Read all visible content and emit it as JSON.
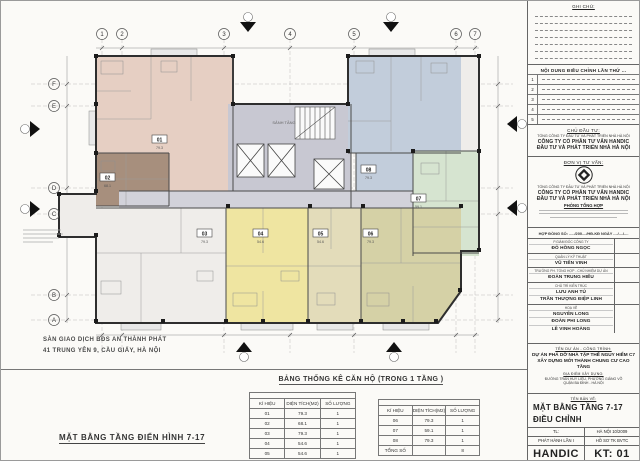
{
  "plan": {
    "grid_top": [
      "1",
      "2",
      "3",
      "4",
      "5",
      "6",
      "7"
    ],
    "grid_left": [
      "F",
      "E",
      "D",
      "C",
      "B",
      "A"
    ],
    "core_label": "SẢNH TẦNG",
    "units": [
      {
        "id": "01",
        "area": "79.3"
      },
      {
        "id": "02",
        "area": "68.1"
      },
      {
        "id": "03",
        "area": "79.3"
      },
      {
        "id": "04",
        "area": "54.6"
      },
      {
        "id": "05",
        "area": "54.6"
      },
      {
        "id": "06",
        "area": "79.3"
      },
      {
        "id": "07",
        "area": "59.1"
      },
      {
        "id": "08",
        "area": "79.3"
      }
    ],
    "colors": {
      "unit01": "#e6cfc3",
      "unit02": "#a78f7d",
      "unit03": "#efedea",
      "unit04": "#efe5a1",
      "unit05": "#e3dcba",
      "unit06": "#d5d1a6",
      "unit07": "#d6e4d0",
      "unit08": "#c2cddb",
      "core": "#c8c8d2",
      "corridor": "#d2d2da"
    }
  },
  "broker_note": {
    "line1": "SÀN GIAO DỊCH BĐS AN THÀNH PHÁT",
    "line2": "41 TRUNG YÊN 9, CẦU GIẤY, HÀ NỘI"
  },
  "drawing_title": "MẶT BẰNG TẦNG ĐIỂN HÌNH 7-17",
  "stats": {
    "title": "BẢNG THỐNG KÊ CĂN HỘ (TRONG 1 TẦNG )",
    "headers": [
      "KÍ HIỆU",
      "DIỆN TÍCH(M2)",
      "SỐ LƯỢNG"
    ],
    "left_rows": [
      [
        "01",
        "79.3",
        "1"
      ],
      [
        "02",
        "68.1",
        "1"
      ],
      [
        "03",
        "79.3",
        "1"
      ],
      [
        "04",
        "54.6",
        "1"
      ],
      [
        "05",
        "54.6",
        "1"
      ]
    ],
    "right_rows": [
      [
        "06",
        "79.3",
        "1"
      ],
      [
        "07",
        "59.1",
        "1"
      ],
      [
        "08",
        "79.3",
        "1"
      ],
      [
        "TỔNG SỐ",
        "",
        "8"
      ]
    ]
  },
  "titleblock": {
    "notes_title": "GHI CHÚ:",
    "revision_title": "NỘI DUNG ĐIỀU CHỈNH LẦN THỨ ...",
    "revision_rows": [
      [
        "1"
      ],
      [
        "2"
      ],
      [
        "3"
      ],
      [
        "4"
      ],
      [
        "5"
      ]
    ],
    "investor": {
      "heading": "CHỦ ĐẦU TƯ:",
      "parent": "TỔNG CÔNG TY ĐẦU TƯ VÀ PHÁT TRIỂN NHÀ HÀ NỘI",
      "name1": "CÔNG TY CỔ PHẦN TƯ VẤN HANDIC",
      "name2": "ĐẦU TƯ VÀ PHÁT TRIỂN NHÀ HÀ NỘI"
    },
    "consultant": {
      "heading": "ĐƠN VỊ TƯ VẤN:",
      "parent": "TỔNG CÔNG TY ĐẦU TƯ VÀ PHÁT TRIỂN NHÀ HÀ NỘI",
      "name1": "CÔNG TY CỔ PHẦN TƯ VẤN HANDIC",
      "name2": "ĐẦU TƯ VÀ PHÁT TRIỂN NHÀ HÀ NỘI",
      "dept": "PHÒNG TỔNG HỢP"
    },
    "contract": "HỢP ĐỒNG SỐ: ...../200..../HĐ-KĐ NGÀY ..../..../....",
    "signatures": [
      {
        "role": "P.GIÁM ĐỐC CÔNG TY",
        "names": [
          "ĐỖ HỒNG NGỌC"
        ]
      },
      {
        "role": "QUẢN LÝ KỸ THUẬT",
        "names": [
          "VŨ TIẾN VINH"
        ]
      },
      {
        "role": "TRƯỞNG PH. TỔNG HỢP - CHỦ NHIỆM DỰ ÁN",
        "names": [
          "ĐOÀN TRUNG HIẾU"
        ]
      },
      {
        "role": "CHỦ TRÌ KIẾN TRÚC",
        "names": [
          "LƯU ANH TÚ",
          "TRẦN THƯỢNG ĐIỆP LINH"
        ]
      },
      {
        "role": "HOẠ VẼ",
        "names": [
          "NGUYỄN LONG",
          "ĐOÀN PHI LONG",
          "LÊ VINH HOÀNG"
        ]
      }
    ],
    "project": {
      "heading": "TÊN DỰ ÁN - CÔNG TRÌNH:",
      "line1": "DỰ ÁN PHÁ DỠ NHÀ TẬP THỂ NGUY HIỂM C7",
      "line2": "XÂY DỰNG MỚI THÀNH CHUNG CƯ CAO TẦNG",
      "site_heading": "ĐỊA ĐIỂM XÂY DỰNG:",
      "site1": "ĐƯỜNG TRẦN HUY LIỆU, PHƯỜNG GIẢNG VÕ",
      "site2": "QUẬN BA ĐÌNH - HÀ NỘI"
    },
    "sheet": {
      "heading": "TÊN BẢN VẼ:",
      "name1": "MẶT BẰNG TẦNG 7-17",
      "name2": "ĐIỀU CHỈNH"
    },
    "footer": {
      "tl": "TL:",
      "place_date": "HÀ NỘI 10/2009",
      "issue": "PHÁT HÀNH LẦN I",
      "dossier": "HỒ SƠ TK BVTC",
      "brand": "HANDIC",
      "sheet_no": "KT: 01"
    }
  }
}
